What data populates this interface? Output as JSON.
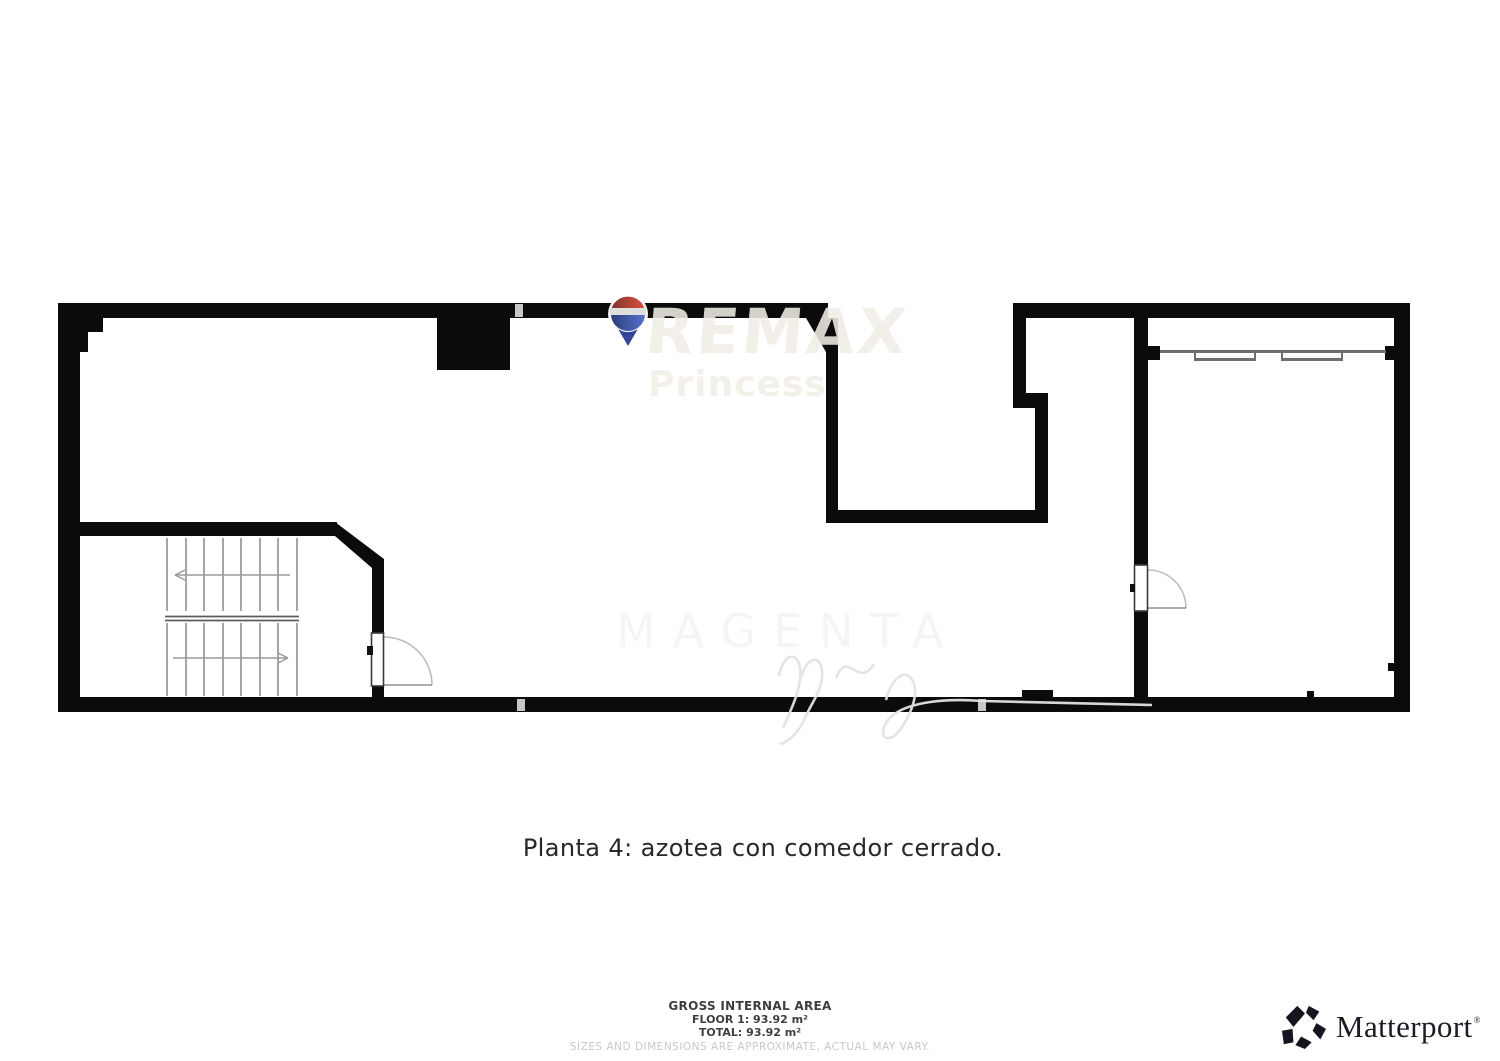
{
  "caption": "Planta 4: azotea con comedor cerrado.",
  "footer": {
    "gross_title": "GROSS INTERNAL AREA",
    "floor_line": "FLOOR 1: 93.92 m²",
    "total_line": "TOTAL: 93.92 m²",
    "disclaimer": "SIZES AND DIMENSIONS ARE APPROXIMATE, ACTUAL MAY VARY."
  },
  "branding": {
    "remax": {
      "name": "REMAX",
      "office": "Princess",
      "balloon_red": "#d94f3d",
      "balloon_blue": "#5873d0"
    },
    "matterport": {
      "wordmark": "Matterport",
      "trademark": "®",
      "color": "#1b1b25"
    }
  },
  "watermark": {
    "ghost_text": "MAGENTA"
  },
  "floorplan": {
    "wall_color": "#0b0b0b",
    "stairs": {
      "flights": 2,
      "treads_per_flight": 8,
      "upper_arrow_direction": "left",
      "lower_arrow_direction": "right"
    },
    "doors_count": 2,
    "window_type": "sliding"
  }
}
